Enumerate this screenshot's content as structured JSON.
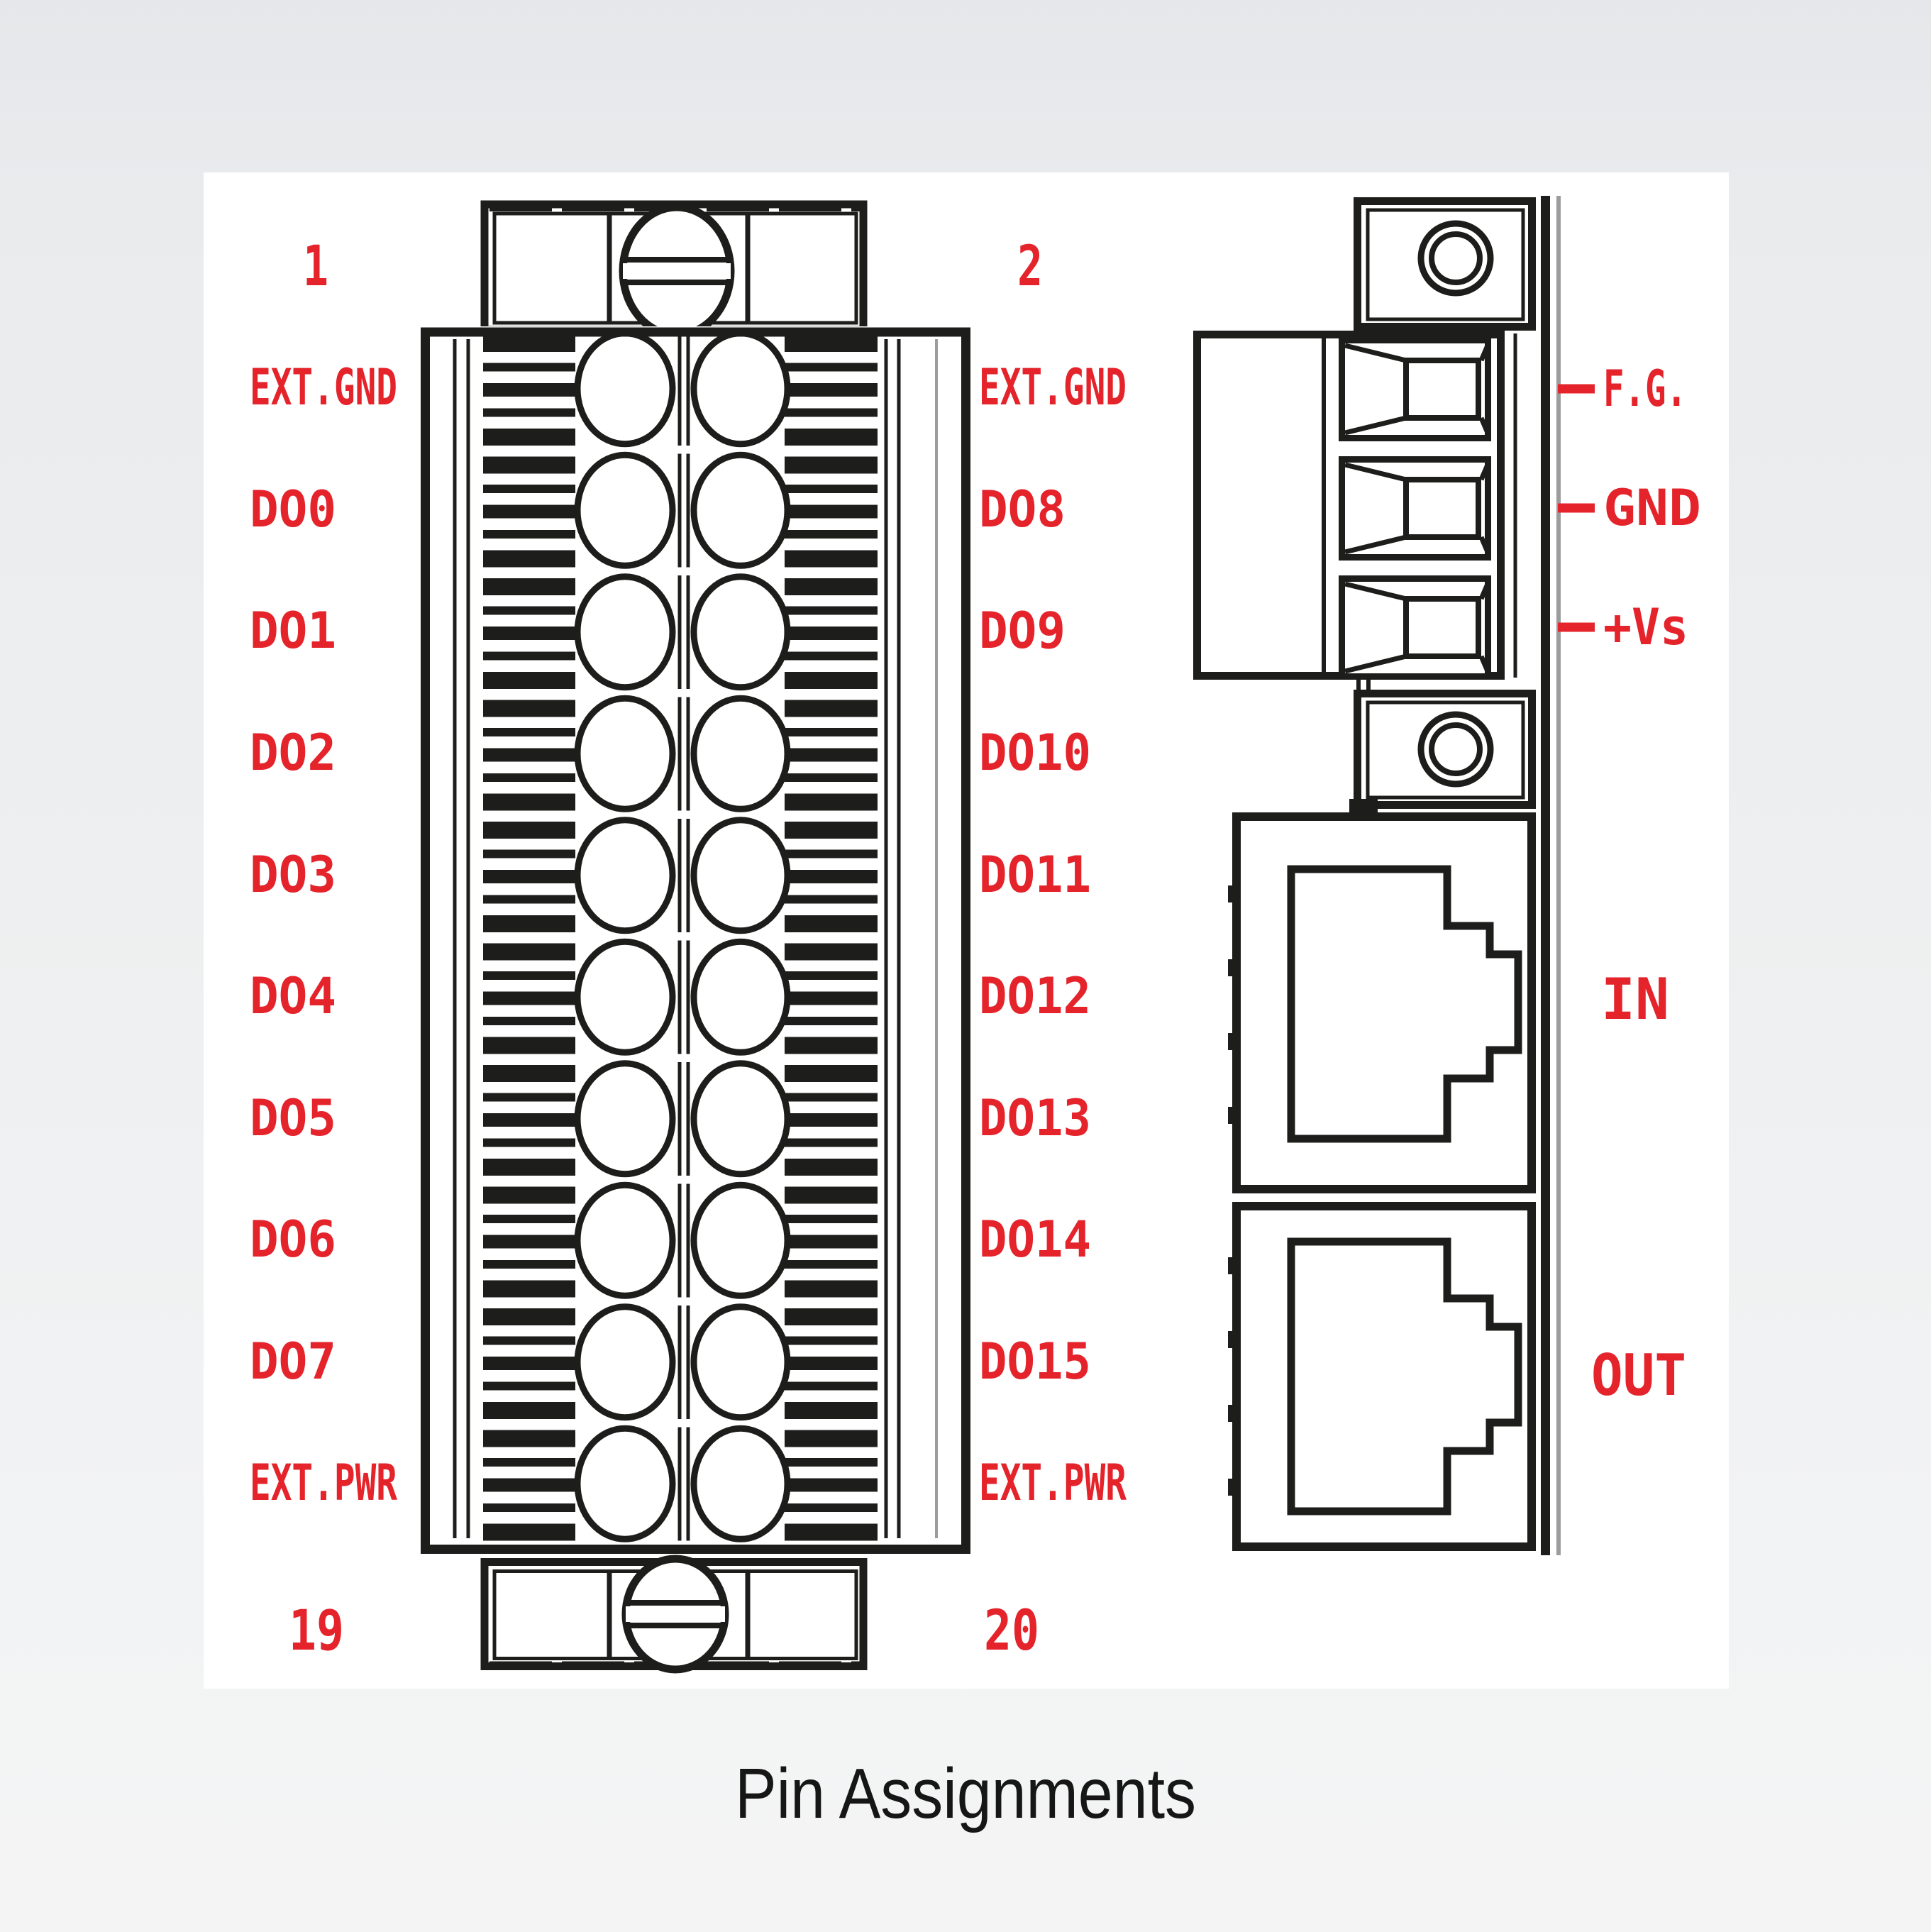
{
  "caption": "Pin Assignments",
  "colors": {
    "label_red": "#e4232b",
    "line_black": "#1d1d1b",
    "line_gray": "#9c9c9c",
    "panel_white": "#ffffff"
  },
  "terminal_block": {
    "corner_numbers": {
      "top_left": "1",
      "top_right": "2",
      "bottom_left": "19",
      "bottom_right": "20"
    },
    "left_pins": [
      "EXT.GND",
      "DO0",
      "DO1",
      "DO2",
      "DO3",
      "DO4",
      "DO5",
      "DO6",
      "DO7",
      "EXT.PWR"
    ],
    "right_pins": [
      "EXT.GND",
      "DO8",
      "DO9",
      "DO10",
      "DO11",
      "DO12",
      "DO13",
      "DO14",
      "DO15",
      "EXT.PWR"
    ]
  },
  "side_view": {
    "power_pins": [
      "F.G.",
      "GND",
      "+Vs"
    ],
    "ports": [
      "IN",
      "OUT"
    ]
  }
}
